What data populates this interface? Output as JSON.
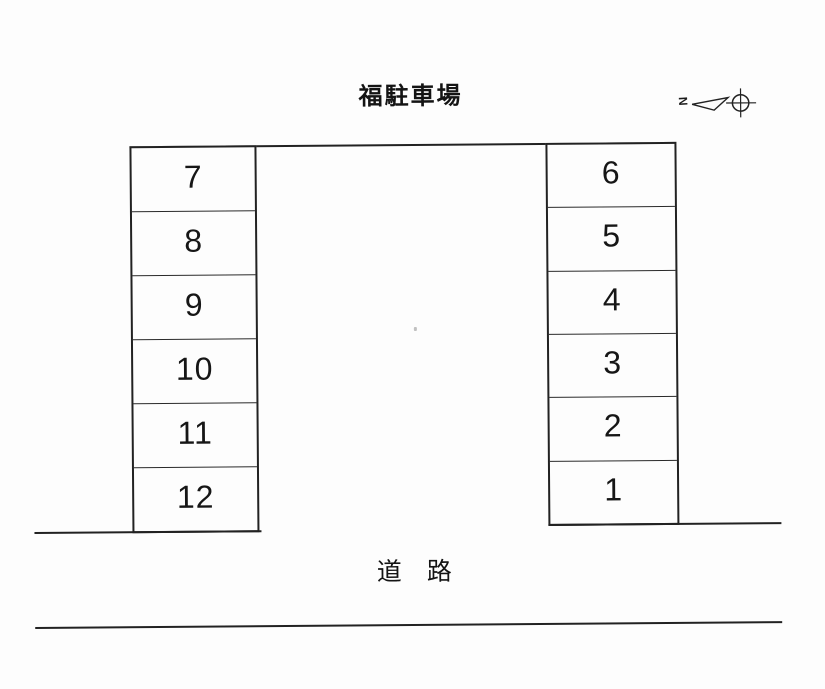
{
  "title": "福駐車場",
  "north_arrow": {
    "label": "N"
  },
  "parking": {
    "left_column": {
      "spots": [
        "7",
        "8",
        "9",
        "10",
        "11",
        "12"
      ]
    },
    "right_column": {
      "spots": [
        "6",
        "5",
        "4",
        "3",
        "2",
        "1"
      ]
    }
  },
  "road": {
    "label": "道　路"
  },
  "colors": {
    "line": "#222222",
    "text": "#141414",
    "background": "#fdfdfd"
  }
}
